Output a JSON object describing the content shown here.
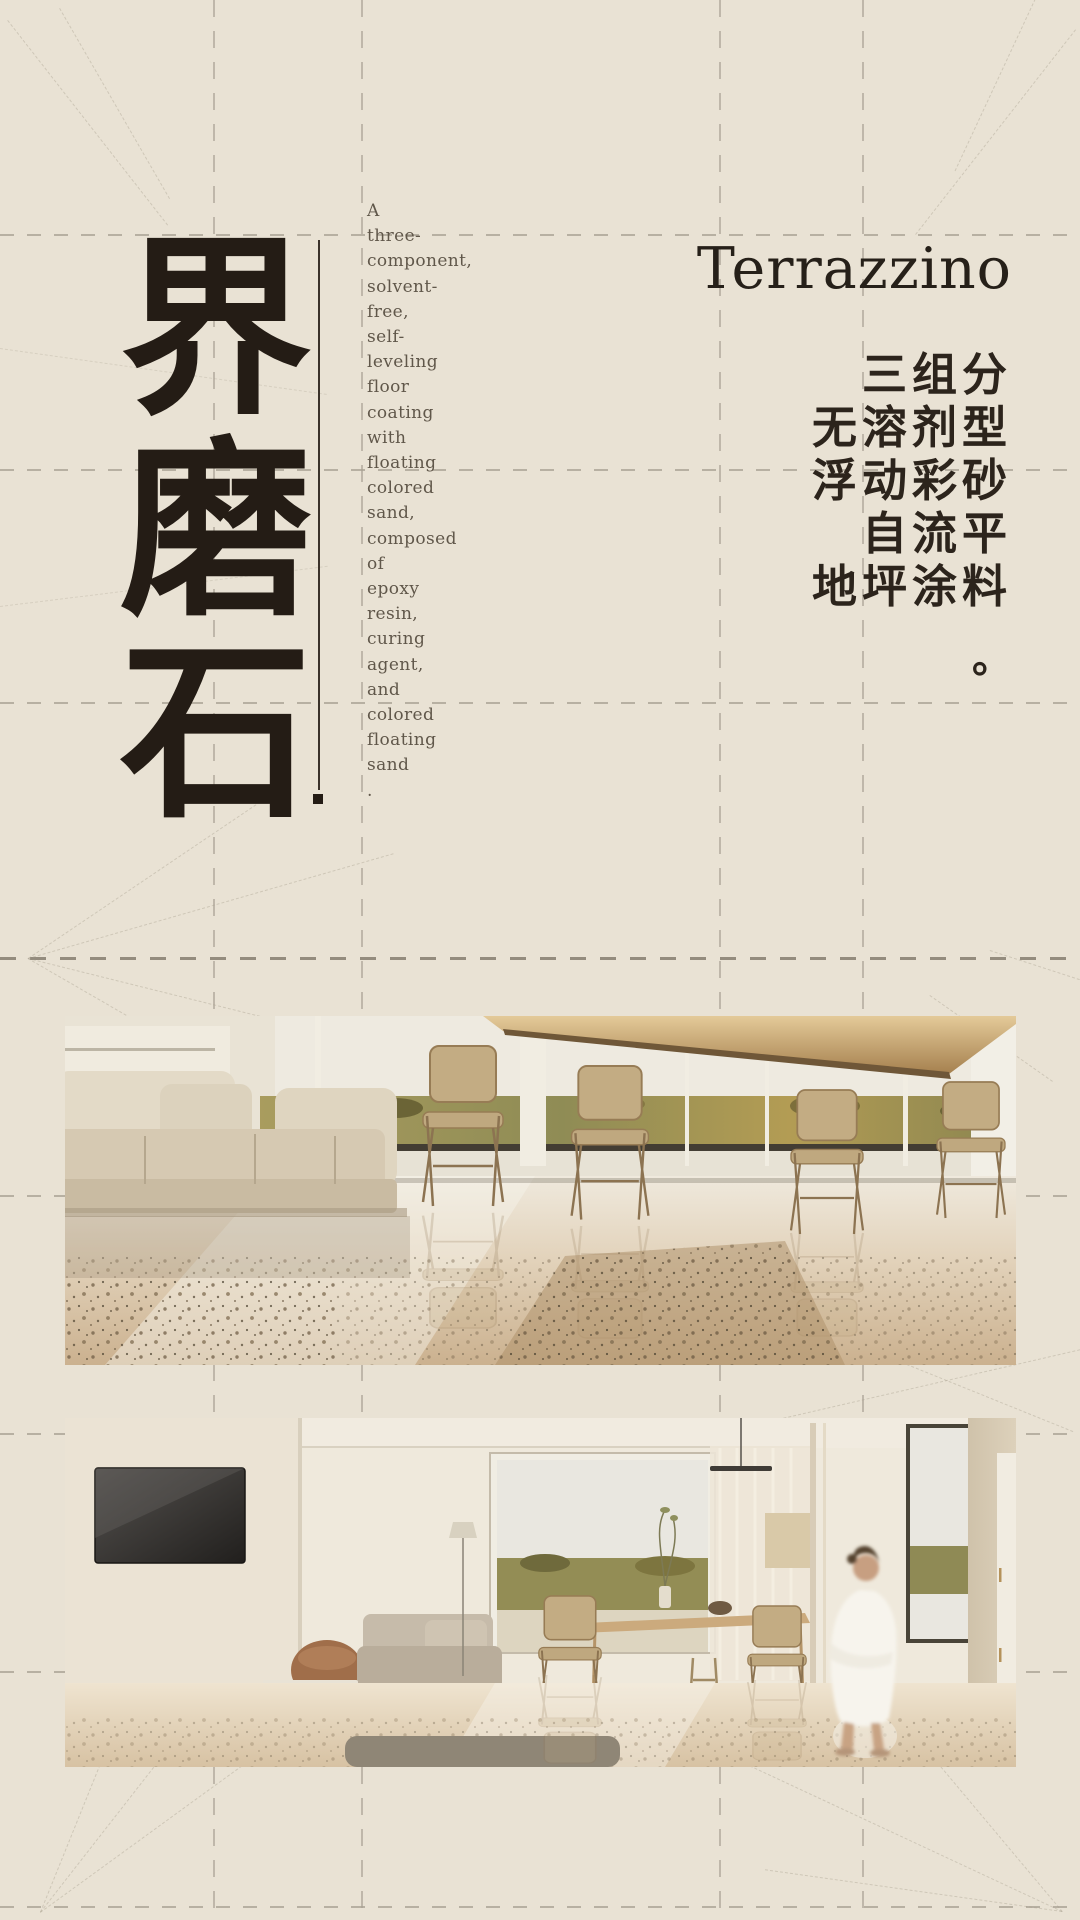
{
  "poster": {
    "palette": {
      "background": "#e9e2d4",
      "ink": "#241c15",
      "muted_text": "#60574a",
      "grid_line": "#a8a093"
    },
    "brand": {
      "title_cn": "界磨石",
      "title_cn_chars": [
        "界",
        "磨",
        "石"
      ],
      "title_en": "Terrazzino"
    },
    "description_en": {
      "lines": [
        "A",
        "three-",
        "component,",
        "solvent-",
        "free,",
        "self-",
        "leveling",
        "floor",
        "coating",
        "with",
        "floating",
        "colored",
        "sand,",
        "composed",
        "of",
        "epoxy",
        "resin,",
        "curing",
        "agent,",
        "and",
        "colored",
        "floating",
        "sand",
        "."
      ]
    },
    "description_cn": {
      "rows": [
        "三组分",
        "无溶剂型",
        "浮动彩砂",
        "自流平",
        "地坪涂料"
      ],
      "period": "。"
    },
    "photos": {
      "photo1_label": "terrazzo floor lounge with cream sofa, wire chairs and field view",
      "photo2_label": "bright living-dining room with TV, person in white robe and glossy floor"
    }
  }
}
